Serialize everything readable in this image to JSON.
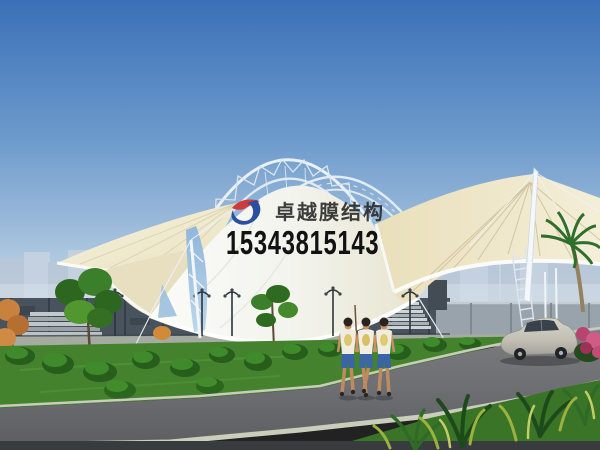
{
  "watermark": {
    "logo_icon": "zhuoyue-membrane-logo-icon",
    "company_name": "卓越膜结构",
    "phone_number": "15343815143",
    "company_text_color": "#2d2d2d",
    "phone_text_color": "#121212",
    "logo_blue": "#2b4fa0",
    "logo_red": "#cf3a3c"
  },
  "scene": {
    "subject": "tensile-membrane-canopy-architectural-rendering",
    "colors": {
      "sky_top": "#3a70b7",
      "sky_horizon": "#cddcea",
      "membrane_white": "#f7f8f3",
      "membrane_cream": "#ece3c1",
      "steel_truss_white": "#e9f0f6",
      "glass_gap_blue": "#8fb6da",
      "wall_dark": "#48535d",
      "wall_light": "#98a3ab",
      "lawn_green": "#44822e",
      "road_gray": "#6f7074",
      "car_silver": "#c9c6bd",
      "bougainvillea_magenta": "#c03a6a"
    }
  }
}
